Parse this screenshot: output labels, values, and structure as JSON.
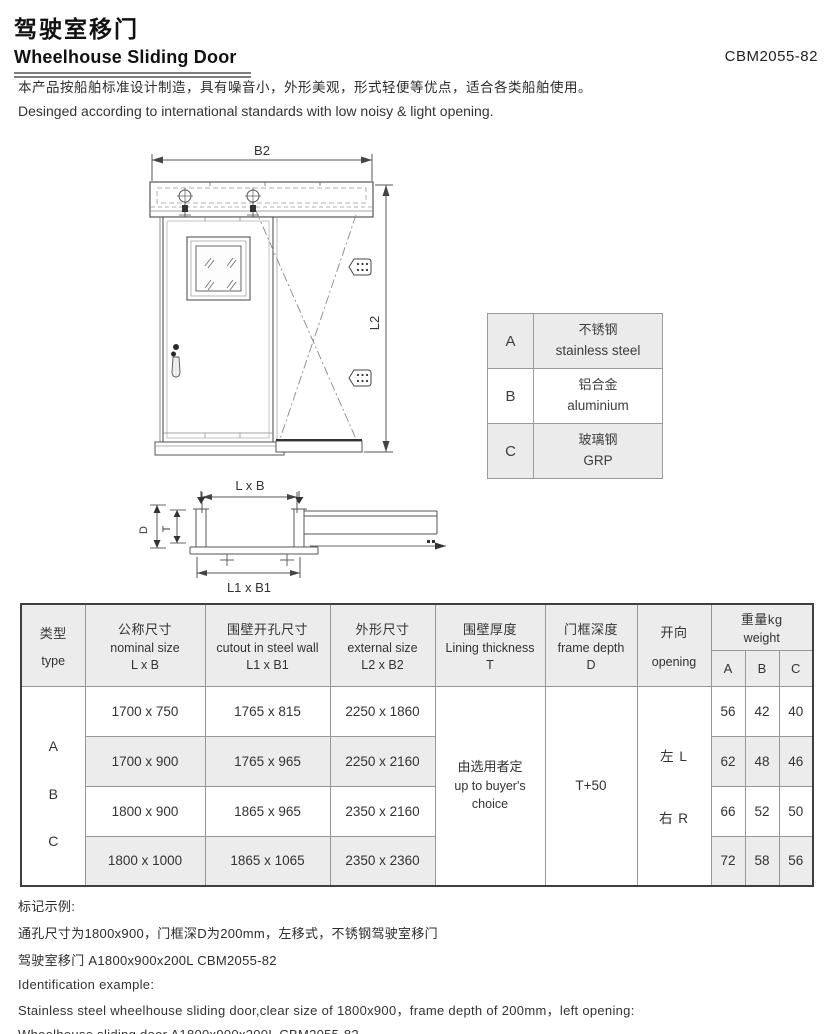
{
  "header": {
    "title_zh": "驾驶室移门",
    "title_en": "Wheelhouse Sliding Door",
    "code": "CBM2055-82",
    "desc_zh": "本产品按船舶标准设计制造，具有噪音小，外形美观，形式轻便等优点，适合各类船舶使用。",
    "desc_en": "Desinged according to international standards with low noisy & light opening."
  },
  "drawing": {
    "labels": {
      "b2": "B2",
      "l2": "L2",
      "lxb": "L x B",
      "l1xb1": "L1 x B1",
      "d": "D",
      "t": "T"
    }
  },
  "material_table": {
    "rows": [
      {
        "key": "A",
        "zh": "不锈钢",
        "en": "stainless steel"
      },
      {
        "key": "B",
        "zh": "铝合金",
        "en": "aluminium"
      },
      {
        "key": "C",
        "zh": "玻璃钢",
        "en": "GRP"
      }
    ]
  },
  "spec_table": {
    "headers": {
      "type": {
        "zh": "类型",
        "en": "type"
      },
      "nominal": {
        "zh": "公称尺寸",
        "en": "nominal size",
        "sub": "L x B"
      },
      "cutout": {
        "zh": "围壁开孔尺寸",
        "en": "cutout in steel wall",
        "sub": "L1 x B1"
      },
      "external": {
        "zh": "外形尺寸",
        "en": "external size",
        "sub": "L2 x B2"
      },
      "lining": {
        "zh": "围壁厚度",
        "en": "Lining thickness",
        "sub": "T"
      },
      "frame": {
        "zh": "门框深度",
        "en": "frame depth",
        "sub": "D"
      },
      "opening": {
        "zh": "开向",
        "en": "opening"
      },
      "weight": {
        "zh": "重量kg",
        "en": "weight",
        "subs": [
          "A",
          "B",
          "C"
        ]
      }
    },
    "types": [
      "A",
      "B",
      "C"
    ],
    "rows": [
      {
        "nominal": "1700 x 750",
        "cutout": "1765 x 815",
        "external": "2250 x 1860",
        "wa": "56",
        "wb": "42",
        "wc": "40"
      },
      {
        "nominal": "1700 x 900",
        "cutout": "1765 x 965",
        "external": "2250 x 2160",
        "wa": "62",
        "wb": "48",
        "wc": "46"
      },
      {
        "nominal": "1800 x 900",
        "cutout": "1865 x 965",
        "external": "2350 x 2160",
        "wa": "66",
        "wb": "52",
        "wc": "50"
      },
      {
        "nominal": "1800 x 1000",
        "cutout": "1865 x 1065",
        "external": "2350 x 2360",
        "wa": "72",
        "wb": "58",
        "wc": "56"
      }
    ],
    "merged": {
      "lining_zh": "由选用者定",
      "lining_en": "up to buyer's choice",
      "frame": "T+50",
      "opening_left": "左 L",
      "opening_right": "右 R"
    }
  },
  "notes": {
    "zh_title": "标记示例:",
    "zh_line1": "通孔尺寸为1800x900，门框深D为200mm，左移式，不锈钢驾驶室移门",
    "zh_line2": "驾驶室移门 A1800x900x200L CBM2055-82",
    "en_title": "Identification example:",
    "en_line1": "Stainless steel wheelhouse sliding door,clear size of 1800x900，frame depth of 200mm，left opening:",
    "en_line2": "Wheelhouse sliding door A1800x900x200L CBM2055-82"
  },
  "colors": {
    "table_header_bg": "#ececec",
    "row_alt_bg": "#ececec",
    "material_row_bg": "#ebebeb",
    "line": "#555555",
    "text": "#222222"
  }
}
